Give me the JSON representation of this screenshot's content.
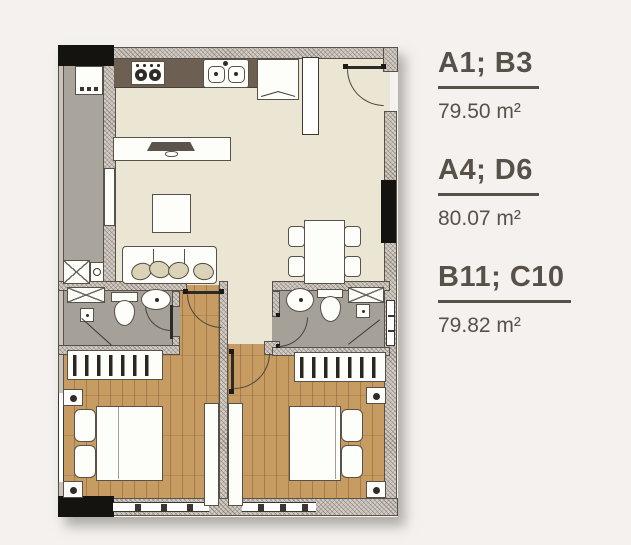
{
  "colors": {
    "page_bg": "#f4f1ee",
    "floor_living": "#eae6d3",
    "floor_wood": "#c69c63",
    "floor_bath": "#a5a098",
    "floor_balcony": "#a9a59d",
    "wall_fill": "#d3ccc4",
    "wall_line": "#57514a",
    "counter": "#6d6052",
    "furniture": "#fdfdfa",
    "cushion": "#dad3b7",
    "black": "#151310",
    "text": "#57514a"
  },
  "legend": {
    "units": [
      {
        "codes": "A1; B3",
        "area": "79.50 m²"
      },
      {
        "codes": "A4; D6",
        "area": "80.07 m²"
      },
      {
        "codes": "B11; C10",
        "area": "79.82 m²"
      }
    ]
  }
}
